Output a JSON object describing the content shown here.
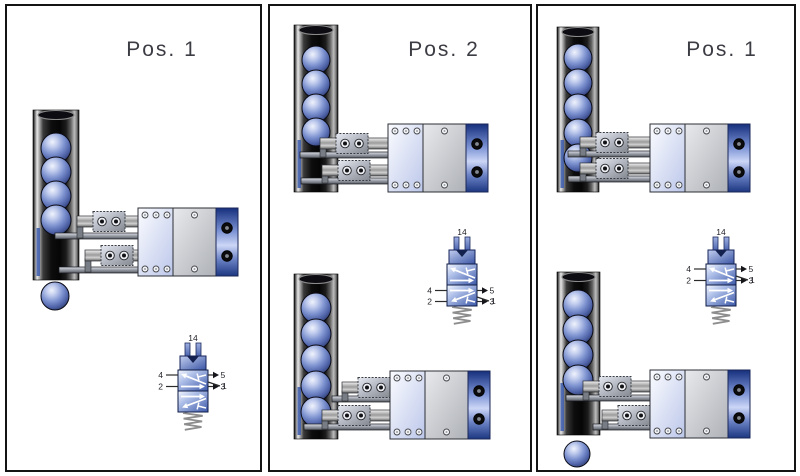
{
  "panels": [
    {
      "title": "Pos. 1",
      "valve": {
        "state": "spring-position",
        "pilot_port_label": "14",
        "port_labels": {
          "p4": "4",
          "p5": "5",
          "p1": "1",
          "p2": "2",
          "p3": "3"
        }
      },
      "mechanisms": [
        {
          "balls_in_tube": 4,
          "balls_ejected": 1
        }
      ]
    },
    {
      "title": "Pos. 2",
      "valve": {
        "state": "actuated",
        "pilot_port_label": "14",
        "port_labels": {
          "p4": "4",
          "p5": "5",
          "p1": "1",
          "p2": "2",
          "p3": "3"
        }
      },
      "mechanisms": [
        {
          "balls_in_tube": 4,
          "balls_ejected": 0
        },
        {
          "balls_in_tube": 5,
          "balls_ejected": 0
        }
      ]
    },
    {
      "title": "Pos. 1",
      "valve": {
        "state": "spring-position",
        "pilot_port_label": "14",
        "port_labels": {
          "p4": "4",
          "p5": "5",
          "p1": "1",
          "p2": "2",
          "p3": "3"
        }
      },
      "mechanisms": [
        {
          "balls_in_tube": 5,
          "balls_ejected": 0
        },
        {
          "balls_in_tube": 4,
          "balls_ejected": 1
        }
      ]
    }
  ],
  "colors": {
    "background": "#ffffff",
    "panel_border": "#141414",
    "ball_blue": "#7e93d0",
    "valve_blue": "#3c58a9",
    "end_cap_blue": "#16307d",
    "title_gray": "#3c3c44"
  }
}
